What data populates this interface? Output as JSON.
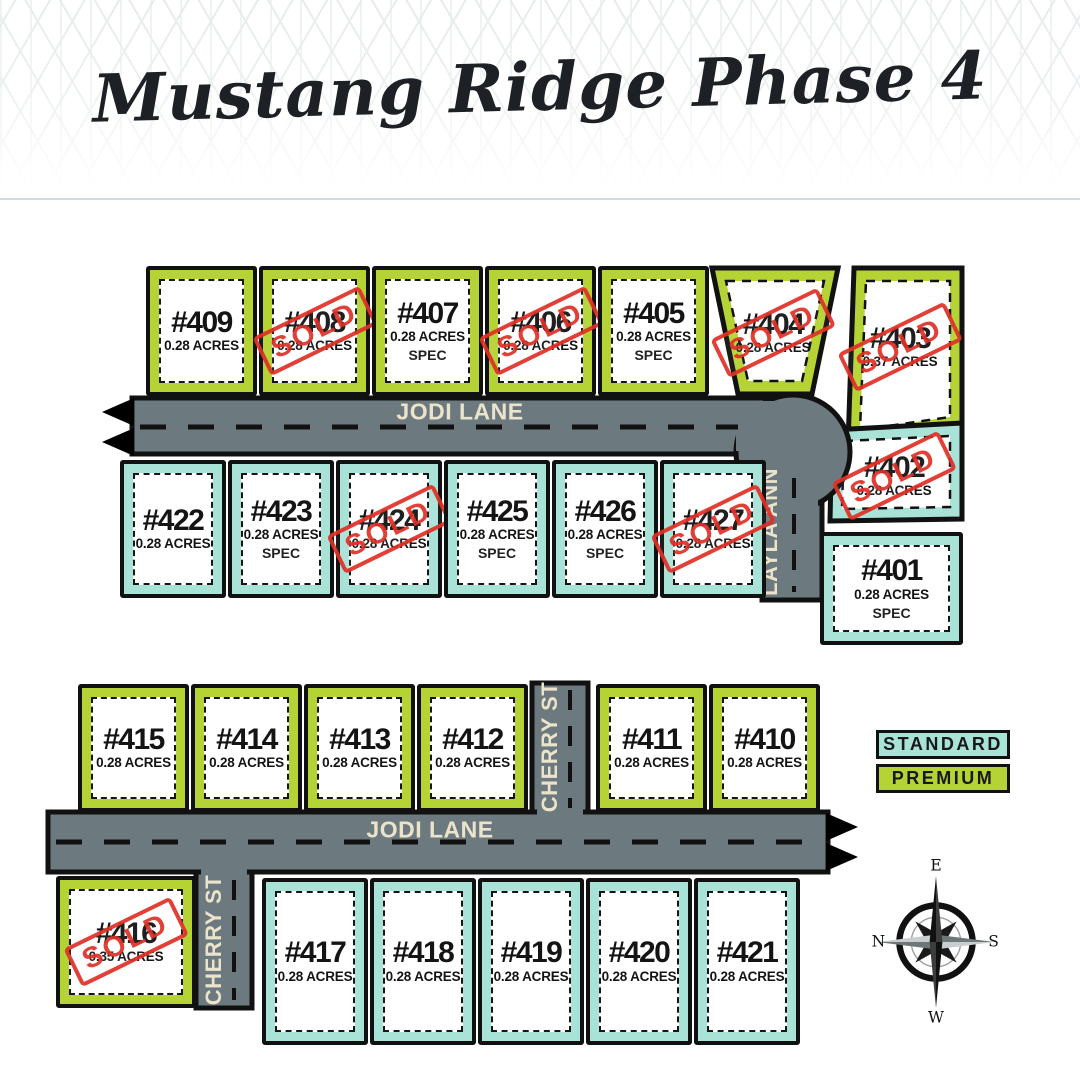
{
  "title": "Mustang Ridge Phase 4",
  "legend": {
    "standard": "STANDARD",
    "premium": "PREMIUM"
  },
  "streets": {
    "jodi_top": "JODI LANE",
    "jodi_bottom": "JODI LANE",
    "layla": "LAYLA ANN",
    "cherry_upper": "CHERRY ST",
    "cherry_lower": "CHERRY ST"
  },
  "stamps": {
    "sold": "SOLD"
  },
  "compass": {
    "n": "N",
    "e": "E",
    "s": "S",
    "w": "W"
  },
  "colors": {
    "premium": "#b5d334",
    "standard": "#a9e2d6",
    "road": "#6c7a80",
    "street_label": "#ece3cb",
    "sold": "#e03127",
    "outline": "#111111"
  },
  "lots": [
    {
      "number": "#409",
      "acres": "0.28 ACRES",
      "tag": "",
      "sold": false,
      "tier": "premium"
    },
    {
      "number": "#408",
      "acres": "0.28 ACRES",
      "tag": "",
      "sold": true,
      "tier": "premium"
    },
    {
      "number": "#407",
      "acres": "0.28 ACRES",
      "tag": "SPEC",
      "sold": false,
      "tier": "premium"
    },
    {
      "number": "#406",
      "acres": "0.28 ACRES",
      "tag": "",
      "sold": true,
      "tier": "premium"
    },
    {
      "number": "#405",
      "acres": "0.28 ACRES",
      "tag": "SPEC",
      "sold": false,
      "tier": "premium"
    },
    {
      "number": "#404",
      "acres": "0.28 ACRES",
      "tag": "",
      "sold": true,
      "tier": "premium"
    },
    {
      "number": "#403",
      "acres": "0.37 ACRES",
      "tag": "",
      "sold": true,
      "tier": "premium"
    },
    {
      "number": "#402",
      "acres": "0.28 ACRES",
      "tag": "",
      "sold": true,
      "tier": "standard"
    },
    {
      "number": "#401",
      "acres": "0.28 ACRES",
      "tag": "SPEC",
      "sold": false,
      "tier": "standard"
    },
    {
      "number": "#422",
      "acres": "0.28 ACRES",
      "tag": "",
      "sold": false,
      "tier": "standard"
    },
    {
      "number": "#423",
      "acres": "0.28 ACRES",
      "tag": "SPEC",
      "sold": false,
      "tier": "standard"
    },
    {
      "number": "#424",
      "acres": "0.28 ACRES",
      "tag": "",
      "sold": true,
      "tier": "standard"
    },
    {
      "number": "#425",
      "acres": "0.28 ACRES",
      "tag": "SPEC",
      "sold": false,
      "tier": "standard"
    },
    {
      "number": "#426",
      "acres": "0.28 ACRES",
      "tag": "SPEC",
      "sold": false,
      "tier": "standard"
    },
    {
      "number": "#427",
      "acres": "0.28 ACRES",
      "tag": "",
      "sold": true,
      "tier": "standard"
    },
    {
      "number": "#415",
      "acres": "0.28 ACRES",
      "tag": "",
      "sold": false,
      "tier": "premium"
    },
    {
      "number": "#414",
      "acres": "0.28 ACRES",
      "tag": "",
      "sold": false,
      "tier": "premium"
    },
    {
      "number": "#413",
      "acres": "0.28 ACRES",
      "tag": "",
      "sold": false,
      "tier": "premium"
    },
    {
      "number": "#412",
      "acres": "0.28 ACRES",
      "tag": "",
      "sold": false,
      "tier": "premium"
    },
    {
      "number": "#411",
      "acres": "0.28 ACRES",
      "tag": "",
      "sold": false,
      "tier": "premium"
    },
    {
      "number": "#410",
      "acres": "0.28 ACRES",
      "tag": "",
      "sold": false,
      "tier": "premium"
    },
    {
      "number": "#416",
      "acres": "0.35 ACRES",
      "tag": "",
      "sold": true,
      "tier": "premium"
    },
    {
      "number": "#417",
      "acres": "0.28 ACRES",
      "tag": "",
      "sold": false,
      "tier": "standard"
    },
    {
      "number": "#418",
      "acres": "0.28 ACRES",
      "tag": "",
      "sold": false,
      "tier": "standard"
    },
    {
      "number": "#419",
      "acres": "0.28 ACRES",
      "tag": "",
      "sold": false,
      "tier": "standard"
    },
    {
      "number": "#420",
      "acres": "0.28 ACRES",
      "tag": "",
      "sold": false,
      "tier": "standard"
    },
    {
      "number": "#421",
      "acres": "0.28 ACRES",
      "tag": "",
      "sold": false,
      "tier": "standard"
    }
  ]
}
